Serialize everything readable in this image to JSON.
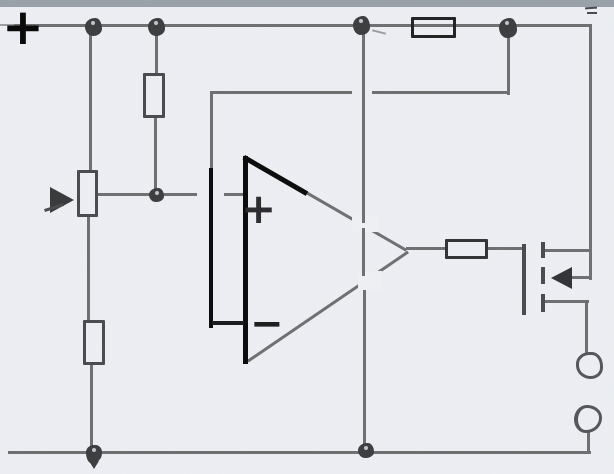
{
  "labels": {
    "supply_plus": "+",
    "opamp_noninverting": "+",
    "opamp_inverting": "−"
  },
  "colors": {
    "paper": "#edeff3",
    "pencil": "#6f7072",
    "pencil_light": "#9b9da0",
    "pencil_dark": "#4b4c4f",
    "ink": "#0d0d0e",
    "node": "#3e3f41",
    "scan_bar": "#9aa1a9",
    "terminal_stroke": "#55575c"
  },
  "components": [
    {
      "id": "supply-plus-terminal",
      "kind": "positive-supply-marker"
    },
    {
      "id": "top-rail",
      "kind": "wire"
    },
    {
      "id": "bottom-rail",
      "kind": "wire"
    },
    {
      "id": "r1",
      "kind": "resistor",
      "orientation": "vertical"
    },
    {
      "id": "r2",
      "kind": "resistor",
      "orientation": "vertical"
    },
    {
      "id": "r3",
      "kind": "resistor",
      "orientation": "horizontal"
    },
    {
      "id": "r4",
      "kind": "resistor",
      "orientation": "horizontal"
    },
    {
      "id": "potentiometer",
      "kind": "potentiometer-with-wiper-arrow"
    },
    {
      "id": "op-amp",
      "kind": "operational-amplifier"
    },
    {
      "id": "mosfet",
      "kind": "n-channel-mosfet"
    },
    {
      "id": "output-terminal-top",
      "kind": "terminal-circle"
    },
    {
      "id": "output-terminal-bottom",
      "kind": "terminal-circle"
    },
    {
      "id": "junction-count",
      "kind": "solder-dots",
      "count": 7
    }
  ]
}
